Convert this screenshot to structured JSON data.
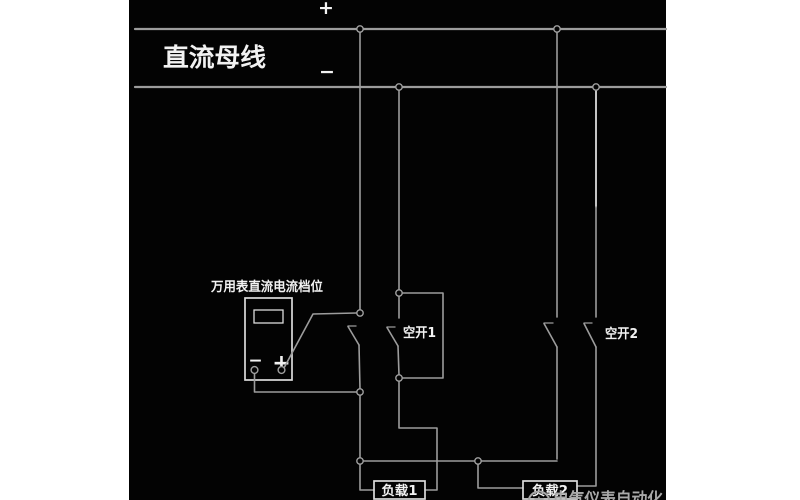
{
  "colors": {
    "background": "#030303",
    "margin": "#ffffff",
    "wire": "#9c9c9c",
    "wire_bright": "#f5f5f5",
    "outline": "#dcdcdc",
    "node": "#a0a0a0",
    "text": "#f2f2f2",
    "watermark": "#a9a9a9"
  },
  "bus": {
    "title": "直流母线",
    "plus": "+",
    "minus": "−"
  },
  "meter": {
    "label": "万用表直流电流档位",
    "minus": "−",
    "plus": "+"
  },
  "breaker1": {
    "label": "空开1"
  },
  "breaker2": {
    "label": "空开2"
  },
  "loads": {
    "load1": "负载1",
    "load2": "负载2"
  },
  "watermark": {
    "logo_glyph": "电",
    "text": "电气仪表自动化"
  }
}
